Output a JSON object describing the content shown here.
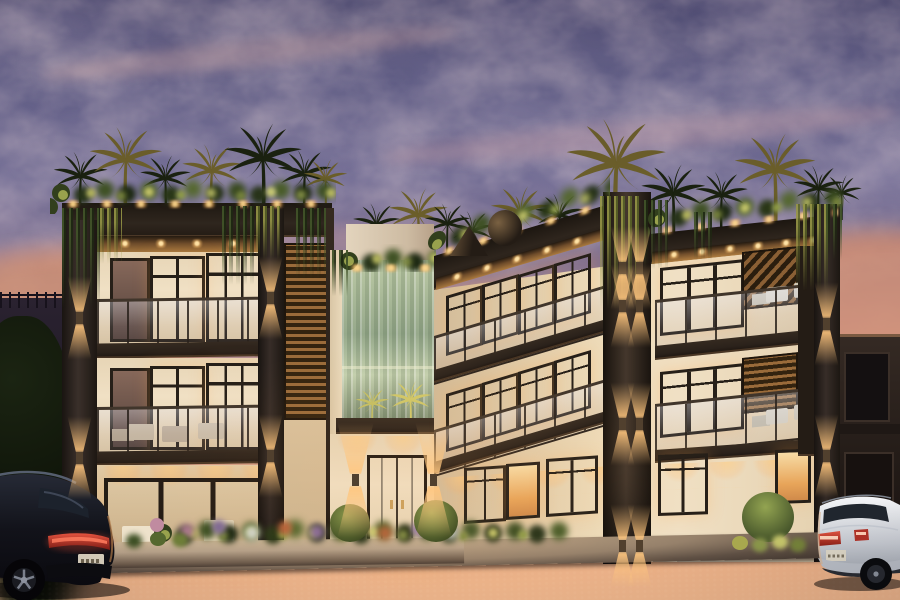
{
  "scene": {
    "label": "twilight-villa-exterior-rendering",
    "setting": "dusk",
    "counts": {
      "building_floors": 3,
      "building_wings": 2,
      "parked_cars": 2
    },
    "objects": [
      "dusk sky with pink altocumulus clouds",
      "three-storey modern villa with dark timber frame",
      "rooftop palm garden with uplights and hanging vines",
      "central glass waterfall feature wall",
      "warm lit interiors and balconies with glass railings",
      "double entrance door with up-down wall sconces",
      "landscaped flower planter beds",
      "black suv parked left",
      "white car parked right",
      "cobbled asphalt street"
    ],
    "palette": {
      "sky_top": "#53517a",
      "sky_mid": "#8a7a96",
      "sky_horizon": "#e2a47e",
      "cloud_pink": "#d6afac",
      "facade_cream": "#f0e0c4",
      "frame_dark": "#2b221b",
      "wood_soffit": "#a8793f",
      "window_warm": "#f7dca6",
      "window_amber": "#e8a55a",
      "sconce_glow": "#ffc67e",
      "foliage_dark": "#1d2511",
      "foliage_lit": "#c6c873",
      "waterfall_light": "#c2cfae",
      "flower_pink": "#c08ba0",
      "flower_purple": "#7f6a94",
      "planter_concrete": "#b5a088",
      "sidewalk": "#c3ab8c",
      "street": "#241d21",
      "suv_black": "#101016",
      "car_white": "#edeef1",
      "taillight_red": "#c8392c",
      "door_brown": "#3a2a1f"
    }
  }
}
